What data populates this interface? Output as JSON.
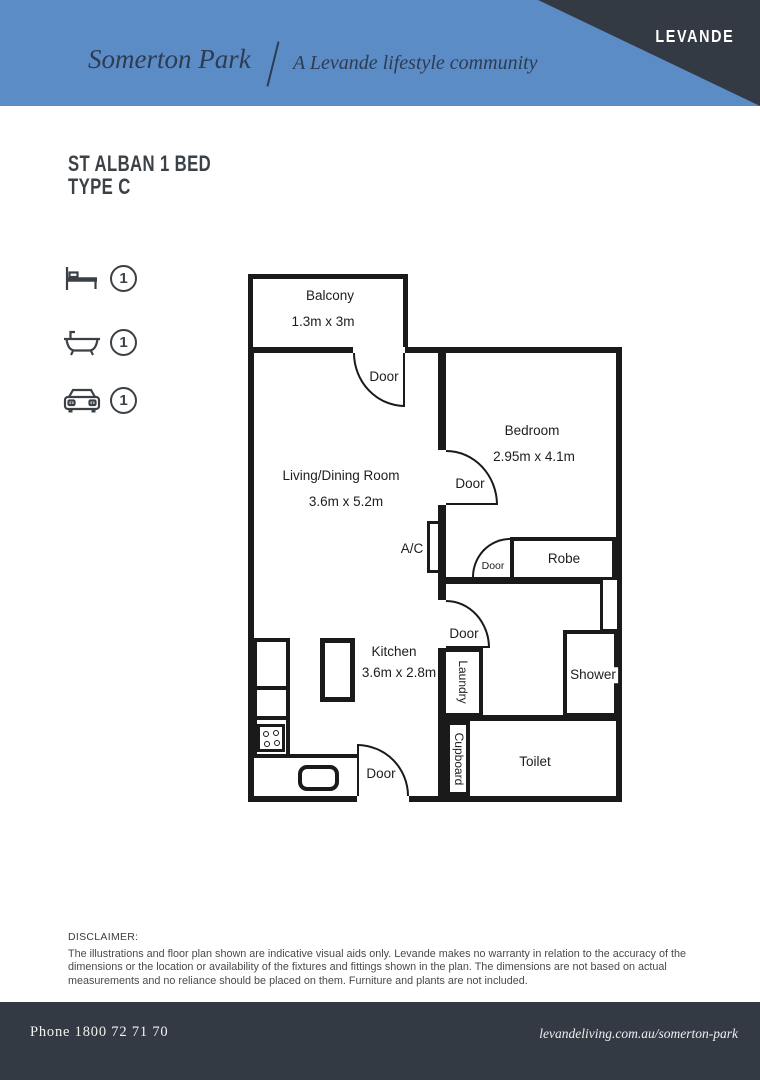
{
  "header": {
    "community_name": "Somerton Park",
    "divider": "/",
    "tagline": "A Levande lifestyle community",
    "brand": "LEVANDE",
    "banner_color": "#5b8cc6",
    "corner_color": "#343a43",
    "text_color": "#2d3c51"
  },
  "plan_title": {
    "line1": "ST ALBAN 1 BED",
    "line2": "TYPE C"
  },
  "features": {
    "items": [
      {
        "icon": "bed-icon",
        "count": "1"
      },
      {
        "icon": "bath-icon",
        "count": "1"
      },
      {
        "icon": "car-icon",
        "count": "1"
      }
    ]
  },
  "floorplan": {
    "line_color": "#1a1a1a",
    "rooms": {
      "balcony": {
        "name": "Balcony",
        "dims": "1.3m x 3m"
      },
      "living": {
        "name": "Living/Dining Room",
        "dims": "3.6m x 5.2m"
      },
      "bedroom": {
        "name": "Bedroom",
        "dims": "2.95m x 4.1m"
      },
      "kitchen": {
        "name": "Kitchen",
        "dims": "3.6m x 2.8m"
      },
      "robe": {
        "name": "Robe"
      },
      "ac": {
        "name": "A/C"
      },
      "laundry": {
        "name": "Laundry"
      },
      "shower": {
        "name": "Shower"
      },
      "cupboard": {
        "name": "Cupboard"
      },
      "toilet": {
        "name": "Toilet"
      }
    },
    "doors": [
      {
        "label": "Door"
      },
      {
        "label": "Door"
      },
      {
        "label": "Door"
      },
      {
        "label": "Door"
      },
      {
        "label": "Door"
      }
    ]
  },
  "disclaimer": {
    "heading": "DISCLAIMER:",
    "body": "The illustrations and floor plan shown are indicative visual aids only. Levande makes no warranty in relation to the accuracy of the dimensions or the location or availability of the fixtures and fittings shown in the plan. The dimensions are not based on actual measurements and no reliance should be placed on them. Furniture and plants are not included."
  },
  "footer": {
    "phone": "Phone 1800 72 71 70",
    "website": "levandeliving.com.au/somerton-park",
    "bg_color": "#343a43"
  }
}
